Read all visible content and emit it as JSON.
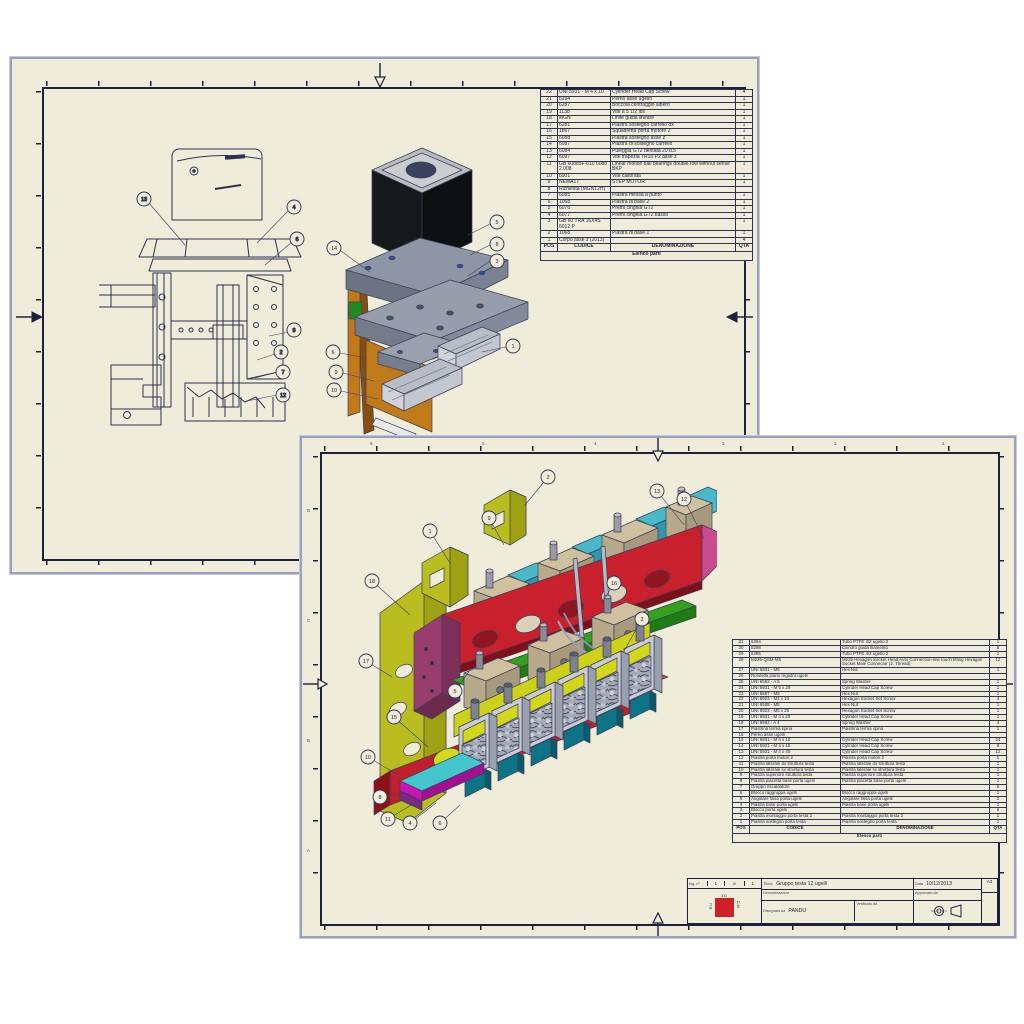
{
  "colors": {
    "paper": "#efecd9",
    "frame": "#1b2240",
    "shadow": "#97a0c0",
    "red_beam": "#c8202c",
    "pink_top": "#e360a9",
    "purple_cap": "#993d6e",
    "green_bar": "#2f9e1c",
    "yellow_bracket": "#b9bd1f",
    "cyan_block": "#49b9c9",
    "tan_block": "#cfc0a0",
    "teal_foot": "#0d7386",
    "magenta_plate": "#cf12b4",
    "orange_block": "#c9761a",
    "motor_black": "#17181c",
    "logo_red": "#cf2027"
  },
  "sheet1": {
    "parts_table": {
      "headers": {
        "pos": "POS",
        "code": "CODICE",
        "desc": "DENOMINAZIONE",
        "qty": "QTA"
      },
      "footer_title": "Elenco parti",
      "rows": [
        {
          "pos": "22",
          "code": "UNI 5931 - M 4 x 10",
          "desc": "Cylinder Head Cap Screw",
          "qty": "4"
        },
        {
          "pos": "21",
          "code": "6294",
          "desc": "Perno asse ugello",
          "qty": "1"
        },
        {
          "pos": "20",
          "code": "6287",
          "desc": "Boccola centraggio albero",
          "qty": "1"
        },
        {
          "pos": "19",
          "code": "1138",
          "desc": "Vite a 5 1/2 lbs",
          "qty": "1"
        },
        {
          "pos": "18",
          "code": "MGN",
          "desc": "Linite guida lineare",
          "qty": "1"
        },
        {
          "pos": "17",
          "code": "6281",
          "desc": "Piastra sostegno carrello dx",
          "qty": "1"
        },
        {
          "pos": "16",
          "code": "1867",
          "desc": "Squadretta porta motore 2",
          "qty": "1"
        },
        {
          "pos": "15",
          "code": "6088",
          "desc": "Piastra sostegno asse z",
          "qty": "1"
        },
        {
          "pos": "14",
          "code": "6087",
          "desc": "Piastra di sostegno carrello",
          "qty": "1"
        },
        {
          "pos": "13",
          "code": "6084",
          "desc": "Puleggia GT2 dentata 20 d.5",
          "qty": "1"
        },
        {
          "pos": "12",
          "code": "6097",
          "desc": "Vite trapezia TR10 P2 asse z",
          "qty": "1"
        },
        {
          "pos": "11",
          "code": "GB 60885F-610 6088 2.008",
          "desc": "Linear motion ball bearings double row without sense BKP",
          "qty": "1"
        },
        {
          "pos": "10",
          "code": "6901",
          "desc": "Vite calibrata",
          "qty": "1"
        },
        {
          "pos": "9",
          "code": "NEMA17",
          "desc": "STEP MOTOR",
          "qty": "1"
        },
        {
          "pos": "8",
          "code": "Richiesta (MGN12H)",
          "desc": "",
          "qty": ""
        },
        {
          "pos": "7",
          "code": "6085",
          "desc": "Piastra messa a punto",
          "qty": "1"
        },
        {
          "pos": "6",
          "code": "1068",
          "desc": "Piastra di base 2",
          "qty": "1"
        },
        {
          "pos": "5",
          "code": "6076",
          "desc": "Premi cinghia GT2",
          "qty": "1"
        },
        {
          "pos": "4",
          "code": "6077",
          "desc": "Premi cinghia GT2 basso",
          "qty": "1"
        },
        {
          "pos": "3",
          "code": "GB 60 TRA 16X4S 6012 P",
          "desc": "",
          "qty": "1"
        },
        {
          "pos": "2",
          "code": "1068",
          "desc": "Piastra di base 1",
          "qty": "1"
        },
        {
          "pos": "1",
          "code": "Corpo asse z (2013)",
          "desc": "",
          "qty": "4"
        }
      ]
    },
    "wireframe_balloons": [
      "13",
      "4",
      "6",
      "9",
      "2",
      "7",
      "12"
    ],
    "colored_balloons": [
      "5",
      "8",
      "3",
      "1",
      "14",
      "6",
      "9",
      "10"
    ]
  },
  "sheet2": {
    "edge_labels": {
      "top": [
        "6",
        "5",
        "4",
        "3",
        "2",
        "1"
      ],
      "left": [
        "D",
        "C",
        "B",
        "A"
      ]
    },
    "balloons": [
      "2",
      "9",
      "1",
      "13",
      "12",
      "18",
      "17",
      "5",
      "15",
      "10",
      "8",
      "11",
      "4",
      "6",
      "3",
      "16"
    ],
    "parts_table": {
      "headers": {
        "pos": "POS",
        "code": "CODICE",
        "desc": "DENOMINAZIONE",
        "qty": "QTA"
      },
      "footer_title": "Elenco parti",
      "rows": [
        {
          "pos": "31",
          "code": "6294",
          "desc": "Tubo PTFE 4/2 ugello 2",
          "qty": "1"
        },
        {
          "pos": "30",
          "code": "6298",
          "desc": "Cilindro guida filamento",
          "qty": "6"
        },
        {
          "pos": "29",
          "code": "6295",
          "desc": "Tubo PTFE 4/2 ugello 2",
          "qty": "1"
        },
        {
          "pos": "28",
          "code": "M225-QSM-M5",
          "desc": "M225 Hexagon Socket Head Auto Connection-line touch fitting Hexagon Socket Male Connector (2. Thread)",
          "qty": "12"
        },
        {
          "pos": "27",
          "code": "UNI 5931 - M6",
          "desc": "Heli Nut",
          "qty": "1"
        },
        {
          "pos": "26",
          "code": "Rondella piano registro ugelli",
          "desc": "",
          "qty": ""
        },
        {
          "pos": "25",
          "code": "UNI 6592 - A 5",
          "desc": "Spring Washer",
          "qty": "1"
        },
        {
          "pos": "24",
          "code": "UNI 5931 - M 5 x 20",
          "desc": "Cylinder Head Cap Screw",
          "qty": "1"
        },
        {
          "pos": "23",
          "code": "UNI 5587 - M6",
          "desc": "Hex Nut",
          "qty": "1"
        },
        {
          "pos": "22",
          "code": "UNI 5923 - M4 x 10",
          "desc": "Hexagon Socket Set Screw",
          "qty": "4"
        },
        {
          "pos": "21",
          "code": "UNI 5588 - M5",
          "desc": "Hex Nut",
          "qty": "1"
        },
        {
          "pos": "20",
          "code": "UNI 5923 - M5 x 25",
          "desc": "Hexagon Socket Set Screw",
          "qty": "1"
        },
        {
          "pos": "19",
          "code": "UNI 5931 - M 4 x 20",
          "desc": "Cylinder Head Cap Screw",
          "qty": "1"
        },
        {
          "pos": "18",
          "code": "UNI 6592 - A 4",
          "desc": "Spring Washer",
          "qty": "4"
        },
        {
          "pos": "17",
          "code": "Piastrina ferma spina",
          "desc": "Piastrina ferma spina",
          "qty": "1"
        },
        {
          "pos": "16",
          "code": "Perno asse ugelli",
          "desc": "",
          "qty": ""
        },
        {
          "pos": "15",
          "code": "UNI 5931 - M 4 x 10",
          "desc": "Cylinder Head Cap Screw",
          "qty": "24"
        },
        {
          "pos": "14",
          "code": "UNI 5931 - M 4 x 16",
          "desc": "Cylinder Head Cap Screw",
          "qty": "8"
        },
        {
          "pos": "13",
          "code": "UNI 5931 - M 4 x 45",
          "desc": "Cylinder Head Cap Screw",
          "qty": "12"
        },
        {
          "pos": "12",
          "code": "Piastra porta motori 2",
          "desc": "Piastra porta motori 2",
          "qty": "1"
        },
        {
          "pos": "11",
          "code": "Piastra laterale dx struttura testa",
          "desc": "Piastra laterale dx struttura testa",
          "qty": "1"
        },
        {
          "pos": "10",
          "code": "Piastra laterale sx struttura testa",
          "desc": "Piastra laterale sx struttura testa",
          "qty": "1"
        },
        {
          "pos": "9",
          "code": "Piastra superiore struttura testa",
          "desc": "Piastra superiore struttura testa",
          "qty": "1"
        },
        {
          "pos": "8",
          "code": "Piastra piacetta base porta ugelli",
          "desc": "Piastra piacetta base porta ugelli",
          "qty": "1"
        },
        {
          "pos": "7",
          "code": "Gruppo riscaldatore",
          "desc": "",
          "qty": "6"
        },
        {
          "pos": "6",
          "code": "Blocco raggruppa ugelli",
          "desc": "Blocco raggruppa ugelli",
          "qty": "1"
        },
        {
          "pos": "5",
          "code": "Angolare fissa porta ugelli",
          "desc": "Angolare fissa porta ugelli",
          "qty": "2"
        },
        {
          "pos": "4",
          "code": "Piastra base porta ugelli",
          "desc": "Piastra base porta ugelli",
          "qty": "1"
        },
        {
          "pos": "3",
          "code": "Blocco porta ugelli",
          "desc": "",
          "qty": "6"
        },
        {
          "pos": "2",
          "code": "Piastra montaggio porta testa 2",
          "desc": "Piastra montaggio porta testa 2",
          "qty": "1"
        },
        {
          "pos": "1",
          "code": "Piastra sostegno porta testa",
          "desc": "Piastra sostegno porta testa",
          "qty": "1"
        }
      ]
    },
    "title_block": {
      "sheet_label": "fog. n°",
      "sheet_num": "1",
      "di": "di",
      "total": "1",
      "titolo_label": "Titolo:",
      "titolo": "Gruppo testa 12 ugelli",
      "denominazione_label": "Denominazione",
      "drawn_label": "Disegnato da",
      "drawn_by": "PANDU",
      "checked_label": "Verificato da",
      "date_label": "Data",
      "date": "10/12/2013",
      "approved_label": "Approvato da",
      "format": "A3",
      "logo_top": "3D",
      "logo_left": "BU",
      "logo_right": "DM"
    }
  }
}
